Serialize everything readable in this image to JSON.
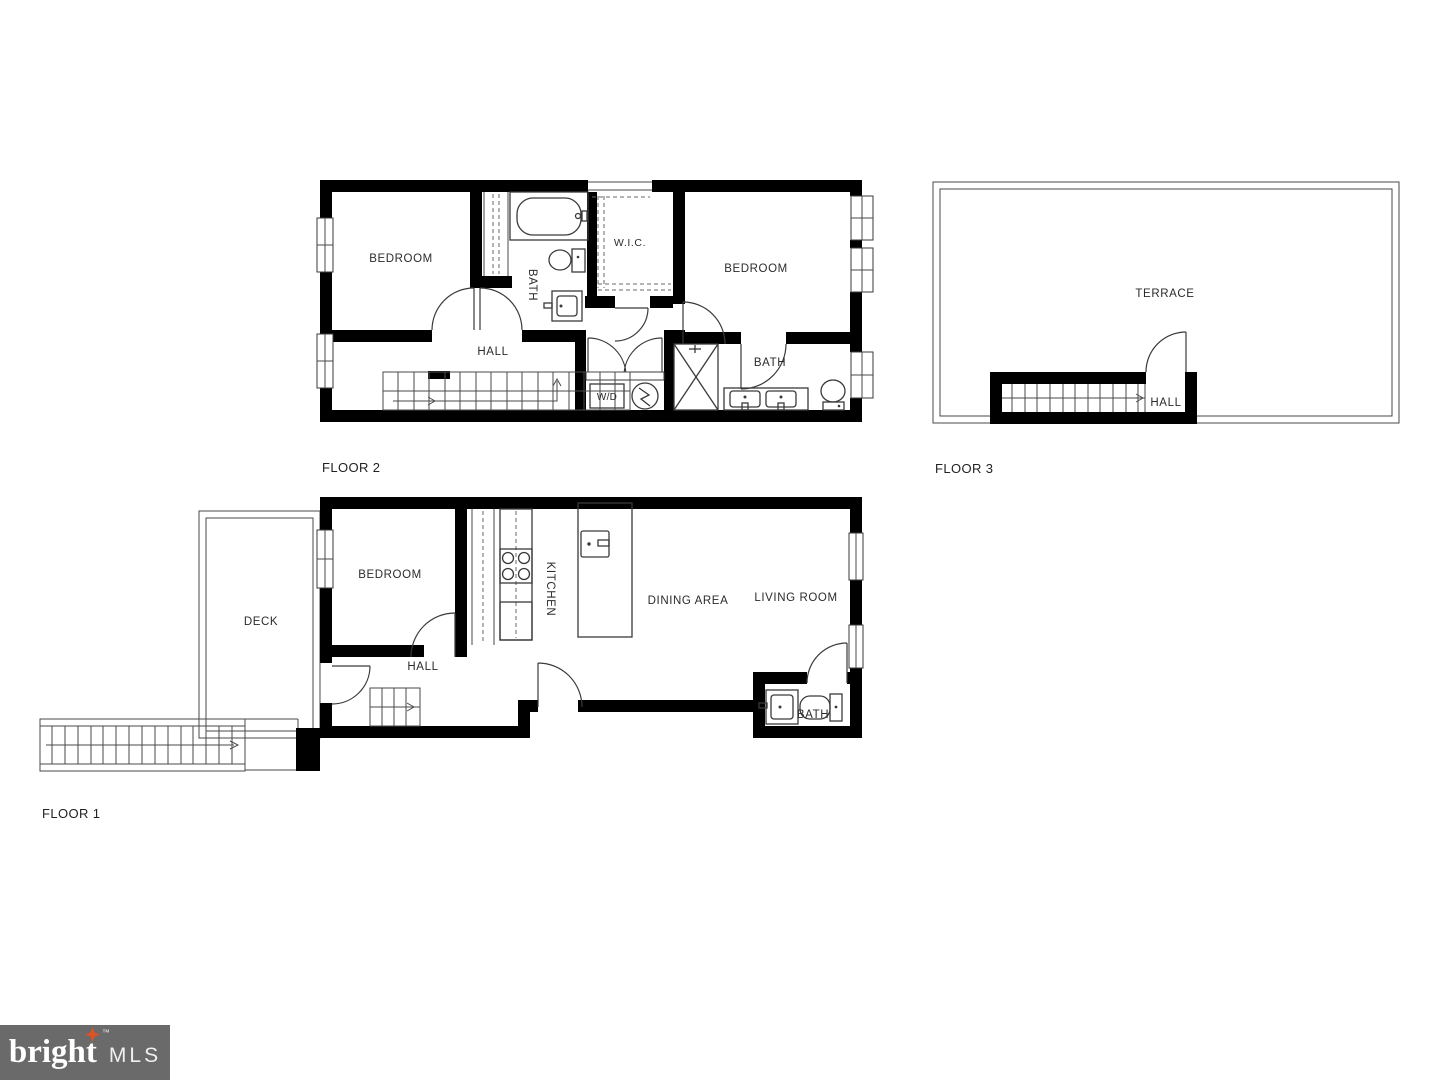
{
  "page": {
    "background": "#ffffff"
  },
  "plan": {
    "floor2": {
      "label": "FLOOR 2",
      "rooms": {
        "bedroom_left": "BEDROOM",
        "bath_upper": "BATH",
        "wic": "W.I.C.",
        "bedroom_right": "BEDROOM",
        "hall": "HALL",
        "laundry": "W/D",
        "bath_lower": "BATH"
      }
    },
    "floor3": {
      "label": "FLOOR 3",
      "rooms": {
        "terrace": "TERRACE",
        "hall": "HALL"
      }
    },
    "floor1": {
      "label": "FLOOR 1",
      "rooms": {
        "deck": "DECK",
        "bedroom": "BEDROOM",
        "kitchen": "KITCHEN",
        "dining": "DINING AREA",
        "living": "LIVING ROOM",
        "hall": "HALL",
        "bath": "BATH"
      }
    }
  },
  "logo": {
    "brand": "bright",
    "tm": "™",
    "suffix": "MLS"
  },
  "colors": {
    "wall": "#000000",
    "line": "#3a3a3a",
    "text": "#2b2b2b",
    "logo_background": "#6a6a6a",
    "logo_text": "#ffffff",
    "accent": "#dd5226"
  }
}
